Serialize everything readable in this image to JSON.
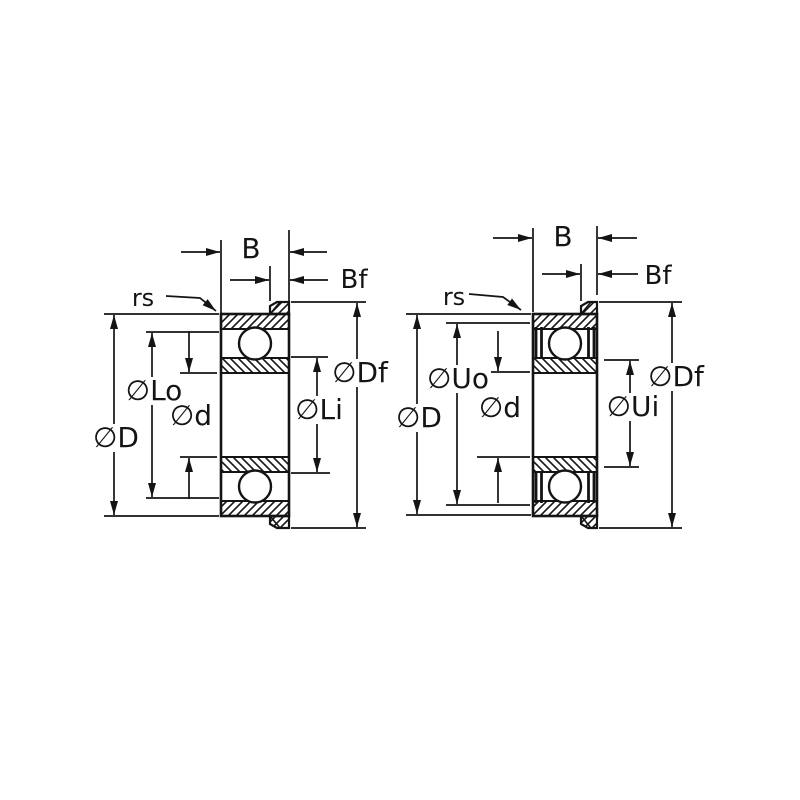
{
  "drawing": {
    "description": "Two cross-section engineering drawings of flanged deep-groove ball bearings with dimension callouts",
    "background_color": "#ffffff",
    "line_color": "#141414",
    "views": [
      {
        "name": "flanged-open-bearing-section",
        "labels": {
          "width": "B",
          "flange_width": "Bf",
          "chamfer_radius": "rs",
          "outer_diameter": "∅D",
          "outer_land_diameter": "∅Lo",
          "bore_diameter": "∅d",
          "inner_land_diameter": "∅Li",
          "flange_diameter": "∅Df"
        }
      },
      {
        "name": "flanged-sealed-bearing-section",
        "labels": {
          "width": "B",
          "flange_width": "Bf",
          "chamfer_radius": "rs",
          "outer_diameter": "∅D",
          "outer_seal_land_diameter": "∅Uo",
          "bore_diameter": "∅d",
          "inner_seal_land_diameter": "∅Ui",
          "flange_diameter": "∅Df"
        }
      }
    ]
  }
}
